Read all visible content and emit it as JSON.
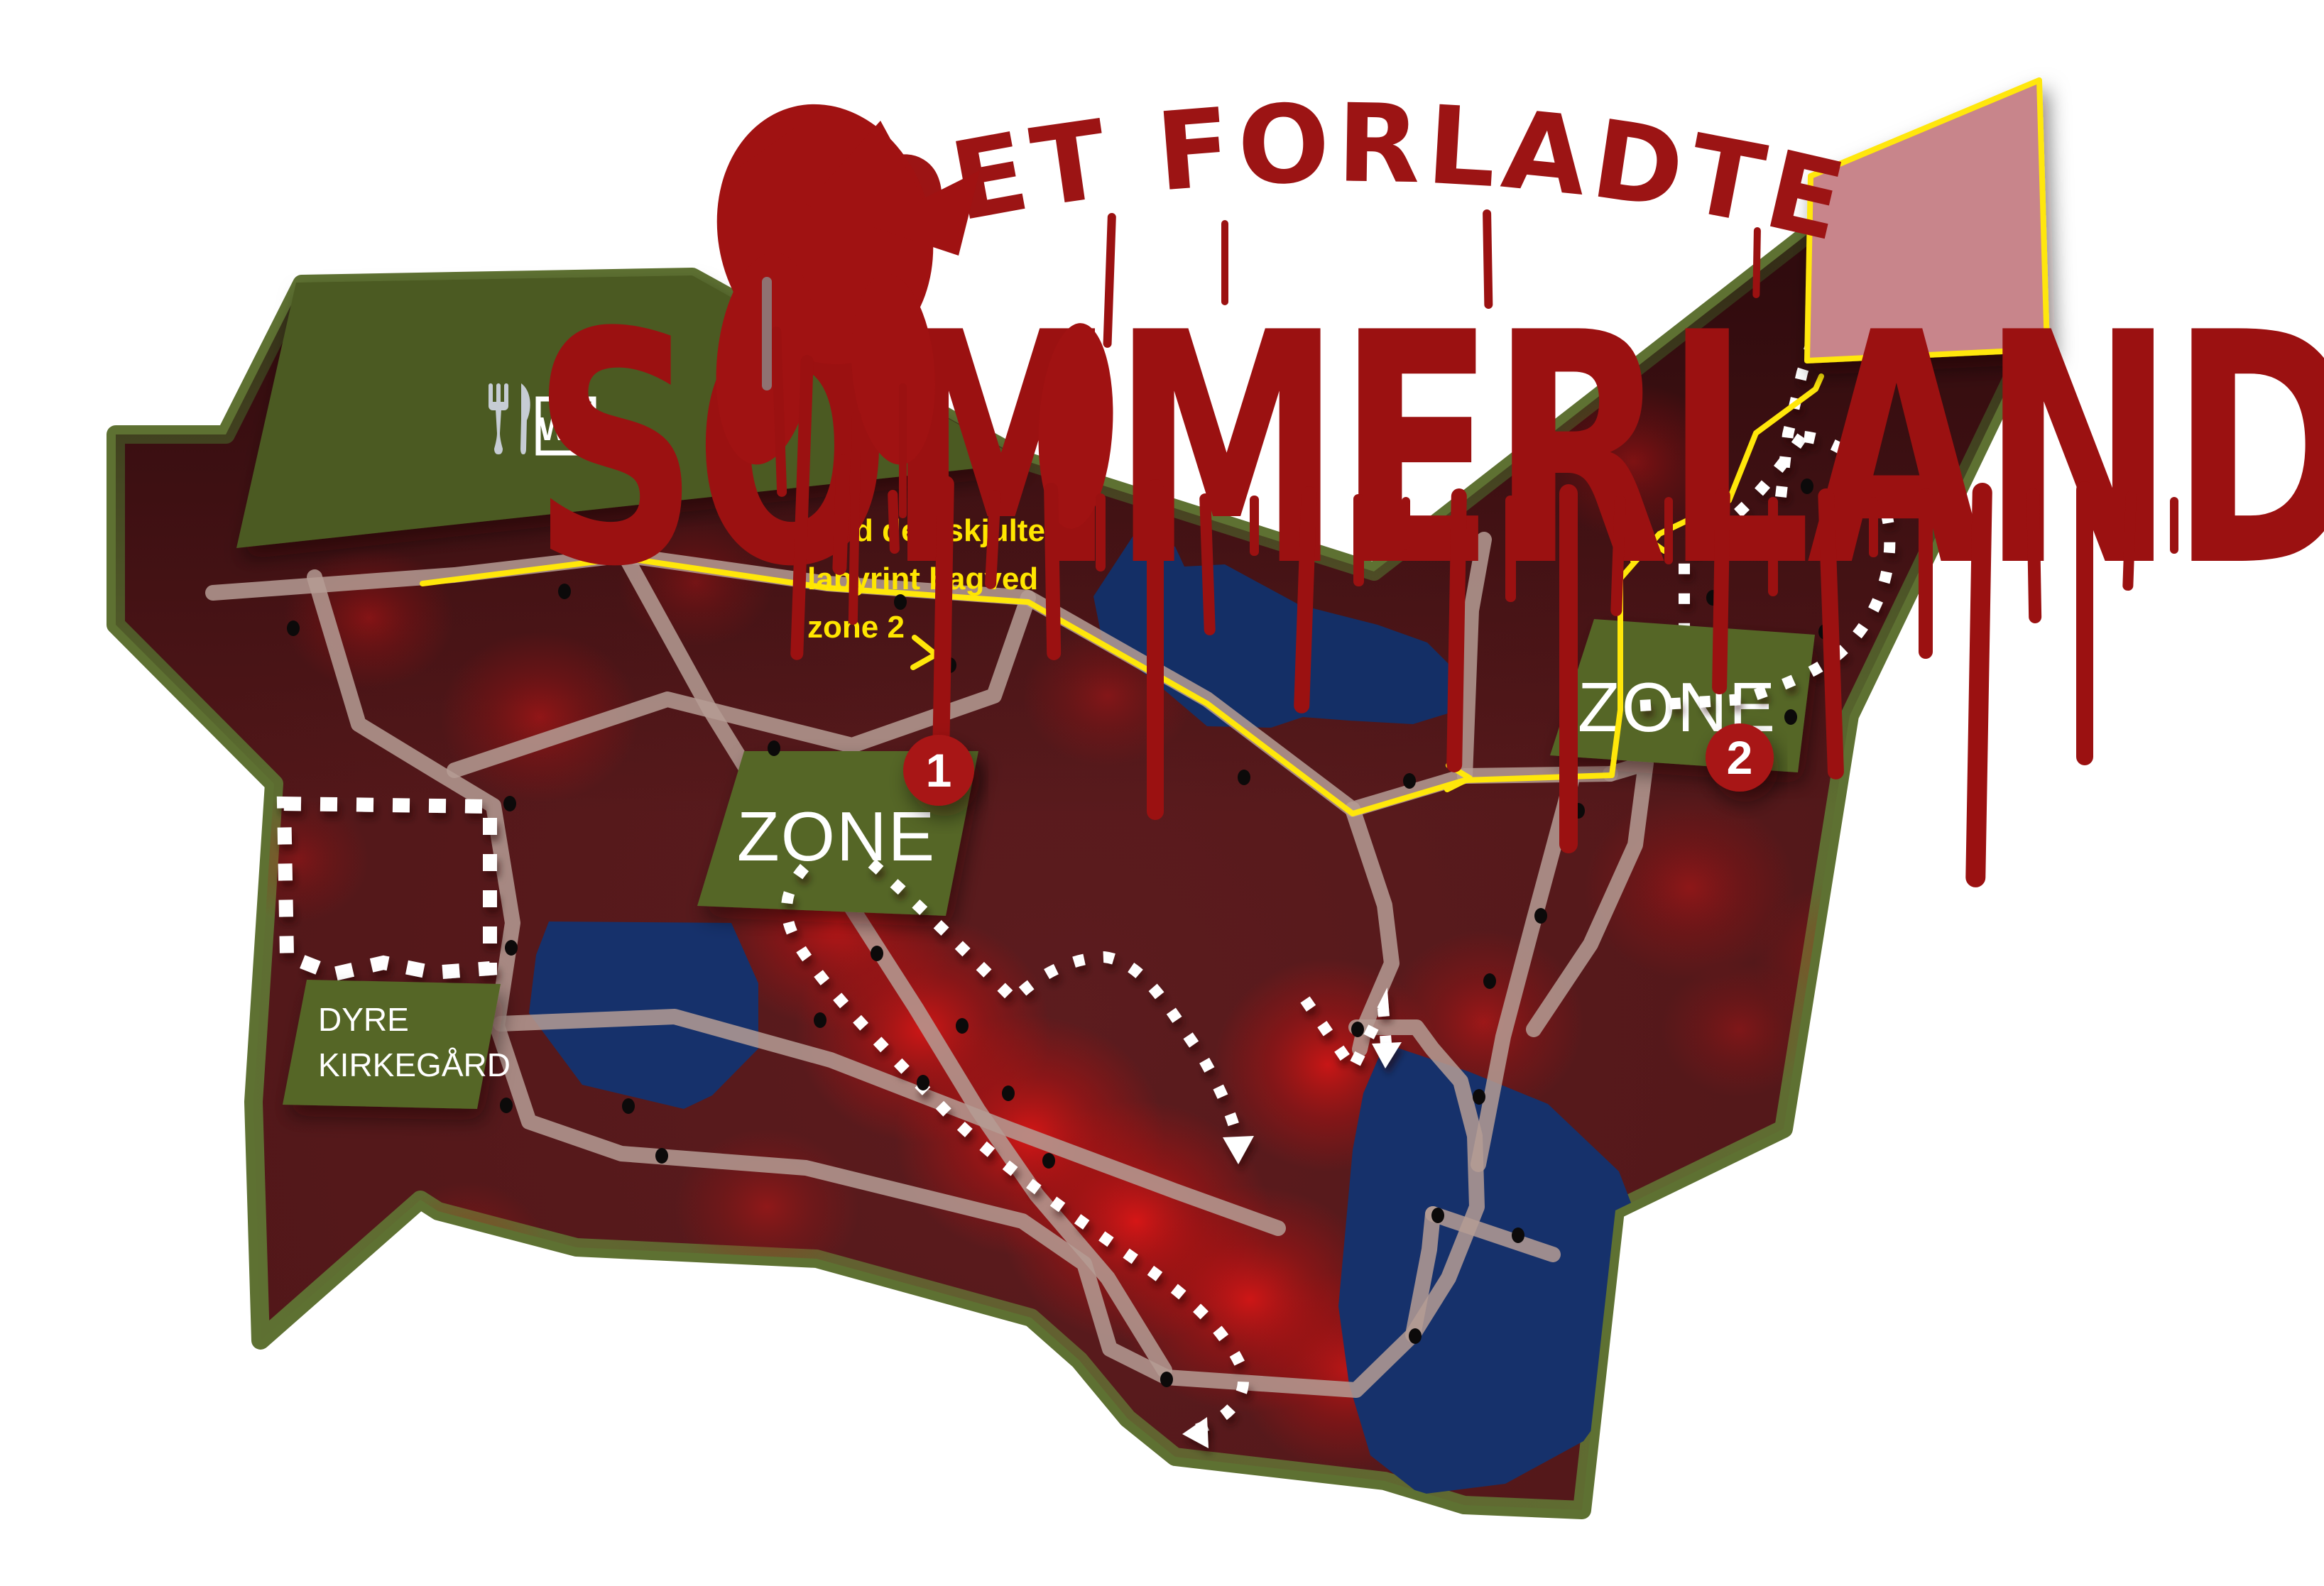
{
  "title": {
    "line1": "DET FORLADTE",
    "line2": "SOMMERLAND"
  },
  "hint": {
    "line1": "Find den skjulte",
    "line2": "labyrint bagved",
    "line3": "zone 2"
  },
  "zone1": {
    "label": "ZONE",
    "number": "1"
  },
  "zone2": {
    "label": "ZONE",
    "number": "2"
  },
  "cemetery": {
    "line1": "DYRE",
    "line2": "KIRKEGÅRD"
  },
  "facilities": {
    "wc": "WC",
    "restaurant_icon": "fork-and-knife-icon"
  },
  "legend_icons": {
    "trail_dotted": "white-dotted-trail",
    "route_yellow": "yellow-route-line",
    "poi_dot": "black-poi-dot"
  },
  "colors": {
    "blood_red": "#9b1111",
    "map_ground": "#521719",
    "map_border_olive": "#5e7132",
    "building_green": "#4b5a21",
    "plate_green": "#556628",
    "lake_navy": "#16316b",
    "road_tan": "#b59c94",
    "route_yellow": "#ffe70a",
    "badge_red": "#a81414",
    "labyrinth_pink": "#c8858b",
    "glow_red": "#d31212",
    "trail_white": "#ffffff"
  }
}
